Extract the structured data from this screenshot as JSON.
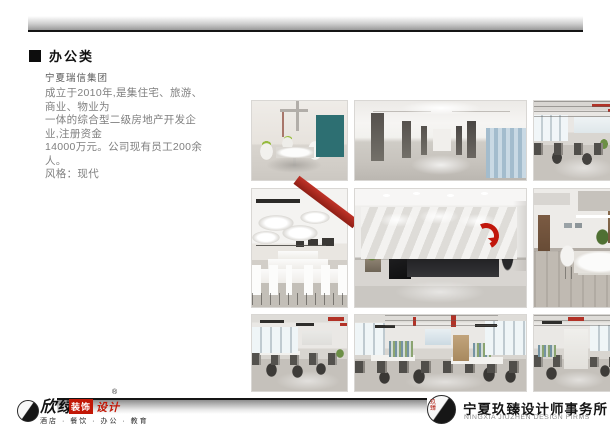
{
  "header": {
    "category_label": "办公类"
  },
  "project": {
    "client_name": "宁夏瑞信集团",
    "description_lines": [
      "成立于2010年,是集住宅、旅游、商业、物业为",
      "一体的综合型二级房地产开发企业,注册资金",
      "14000万元。公司现有员工200余人。",
      "风格：现代"
    ]
  },
  "gallery": {
    "photos": [
      {
        "name": "meeting-room-render"
      },
      {
        "name": "corridor-render"
      },
      {
        "name": "open-office-render-a"
      },
      {
        "name": "conference-room-render"
      },
      {
        "name": "reception-wall-render"
      },
      {
        "name": "manager-office-render"
      },
      {
        "name": "open-office-render-b"
      },
      {
        "name": "open-office-render-c"
      },
      {
        "name": "open-office-render-d"
      }
    ]
  },
  "footer": {
    "left_brand": {
      "seal_chars": "欣绿",
      "script_name": "欣绿",
      "badge_label": "装饰",
      "accent_label": "设计",
      "registered_mark": "®",
      "tagline": "酒店 · 餐饮 · 办公 · 教育"
    },
    "right_brand": {
      "seal_chars": "玖臻",
      "name_cn": "宁夏玖臻设计师事务所",
      "name_en": "NINGXIA JIUZHEN DESIGN FIRMS"
    }
  },
  "colors": {
    "accent_red": "#b23227",
    "brand_red": "#c21807",
    "rule_black": "#151515",
    "frame_teal": "#2d6f72"
  }
}
